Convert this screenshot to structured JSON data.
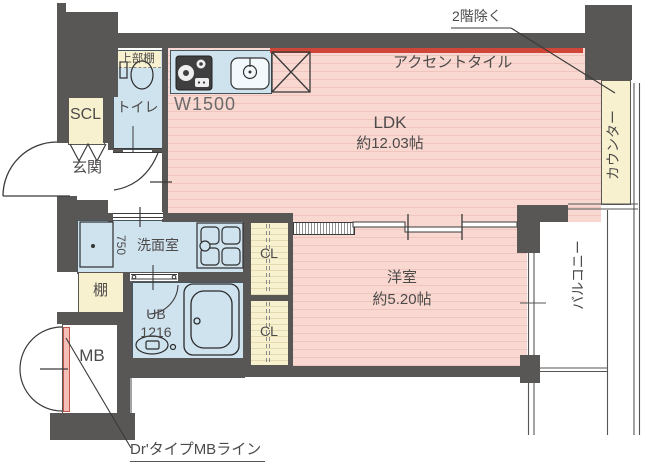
{
  "plan": {
    "title": "1LDK apartment floor plan",
    "notes": {
      "second_floor": "2階除く",
      "accent_tile": "アクセントタイル",
      "mb_line": "Dr'タイプMBライン",
      "kitchen_width": "W1500"
    },
    "rooms": {
      "ldk": {
        "name": "LDK",
        "size": "約12.03帖"
      },
      "western": {
        "name": "洋室",
        "size": "約5.20帖"
      },
      "entrance": {
        "name": "玄関"
      },
      "toilet": {
        "name": "トイレ",
        "upper_shelf": "上部棚"
      },
      "washroom": {
        "name": "洗面室",
        "vanity_width": "750"
      },
      "bath": {
        "name": "UB",
        "size": "1216"
      },
      "scl": {
        "name": "SCL"
      },
      "shelf": {
        "name": "棚"
      },
      "mb": {
        "name": "MB"
      },
      "cl_upper": {
        "name": "CL"
      },
      "cl_lower": {
        "name": "CL"
      },
      "counter": {
        "name": "カウンター"
      },
      "balcony": {
        "name": "バルコニー"
      }
    },
    "colors": {
      "wall": "#595656",
      "floor_pink": "#f8d8d0",
      "floor_stripe": "#efc5bd",
      "wet_area_blue": "#cfe3ef",
      "closet_cream": "#f7f1cf",
      "accent_tile_red": "#cf4638",
      "mb_line_red": "#c0564c"
    }
  }
}
